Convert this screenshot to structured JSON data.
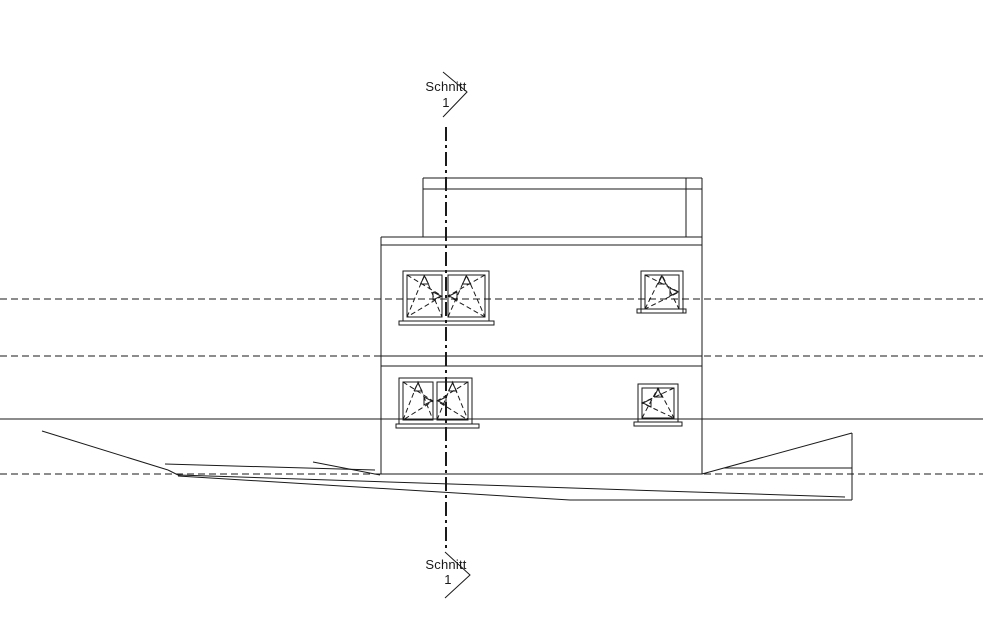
{
  "labels": {
    "section_top": {
      "line1": "Schnitt",
      "line2": "1"
    },
    "section_bottom": {
      "line1": "Schnitt",
      "line2": "1"
    }
  },
  "colors": {
    "line": "#1a1a1a",
    "background": "#ffffff"
  },
  "drawing": {
    "canvas": {
      "width": 983,
      "height": 633
    },
    "level_lines": [
      {
        "name": "level-line-upper-storey",
        "y": 299,
        "x1": 0,
        "x2": 983,
        "style": "dashed"
      },
      {
        "name": "level-line-floor-slab",
        "y": 356,
        "x1": 0,
        "x2": 983,
        "style": "dashed"
      },
      {
        "name": "level-line-ground-floor",
        "y": 419,
        "x1": 0,
        "x2": 983,
        "style": "solid"
      },
      {
        "name": "level-line-base",
        "y": 474,
        "x1": 0,
        "x2": 983,
        "style": "dashed"
      }
    ],
    "building": {
      "name": "building-outline",
      "segments": [
        [
          381,
          237,
          381,
          474
        ],
        [
          702,
          237,
          702,
          474
        ],
        [
          381,
          237,
          702,
          237
        ],
        [
          381,
          245,
          702,
          245
        ],
        [
          381,
          356,
          702,
          356
        ],
        [
          381,
          366,
          702,
          366
        ],
        [
          381,
          474,
          702,
          474
        ],
        [
          423,
          178,
          702,
          178
        ],
        [
          423,
          189,
          702,
          189
        ],
        [
          423,
          178,
          423,
          237
        ],
        [
          702,
          178,
          702,
          237
        ],
        [
          686,
          178,
          686,
          237
        ]
      ]
    },
    "windows": [
      {
        "name": "window-upper-left-double",
        "outer": [
          403,
          271,
          86,
          50
        ],
        "sill": [
          399,
          321,
          95,
          4
        ],
        "sashes": [
          {
            "rect": [
              407,
              275,
              35,
              42
            ],
            "turn": "right"
          },
          {
            "rect": [
              448,
              275,
              37,
              42
            ],
            "turn": "left"
          }
        ]
      },
      {
        "name": "window-upper-right",
        "outer": [
          641,
          271,
          42,
          42
        ],
        "sill": [
          637,
          309,
          49,
          4
        ],
        "sashes": [
          {
            "rect": [
              645,
              275,
              34,
              34
            ],
            "turn": "right"
          }
        ]
      },
      {
        "name": "window-lower-left-double",
        "outer": [
          399,
          378,
          73,
          46
        ],
        "sill": [
          396,
          424,
          83,
          4
        ],
        "sashes": [
          {
            "rect": [
              403,
              382,
              30,
              38
            ],
            "turn": "right"
          },
          {
            "rect": [
              437,
              382,
              31,
              38
            ],
            "turn": "left"
          }
        ]
      },
      {
        "name": "window-lower-right",
        "outer": [
          638,
          384,
          40,
          38
        ],
        "sill": [
          634,
          422,
          48,
          4
        ],
        "sashes": [
          {
            "rect": [
              642,
              388,
              32,
              30
            ],
            "turn": "left"
          }
        ]
      }
    ],
    "terrain": {
      "name": "terrain-lines",
      "segments": [
        [
          42,
          431,
          168,
          470
        ],
        [
          168,
          470,
          178,
          475
        ],
        [
          165,
          464,
          375,
          470
        ],
        [
          313,
          462,
          380,
          475
        ],
        [
          178,
          475,
          845,
          497
        ],
        [
          178,
          476,
          570,
          500
        ],
        [
          570,
          500,
          852,
          500
        ],
        [
          702,
          474,
          852,
          433
        ],
        [
          852,
          433,
          852,
          500
        ],
        [
          724,
          468,
          852,
          468
        ]
      ]
    },
    "section": {
      "name": "section-cut-line",
      "x": 446,
      "y1": 127,
      "y2": 548,
      "arrow_top": [
        443,
        72,
        467,
        92,
        443,
        117
      ],
      "arrow_bottom": [
        445,
        552,
        470,
        575,
        445,
        598
      ]
    }
  }
}
